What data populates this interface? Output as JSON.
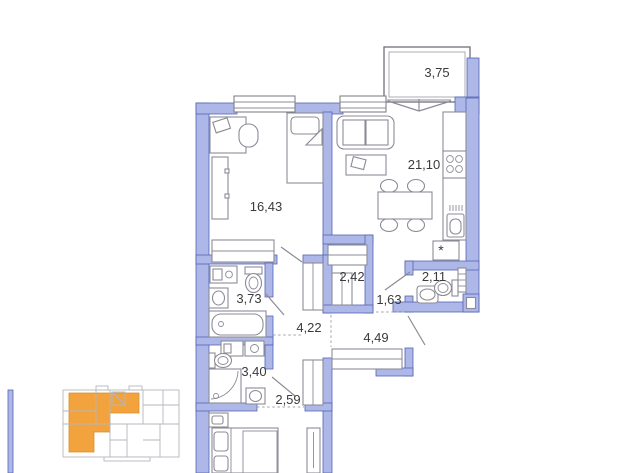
{
  "plan": {
    "rooms": [
      {
        "id": "balcony",
        "area": "3,75"
      },
      {
        "id": "bedroom",
        "area": "16,43"
      },
      {
        "id": "kitchen-living-room",
        "area": "21,10"
      },
      {
        "id": "wardrobe-closet",
        "area": "2,42"
      },
      {
        "id": "wc",
        "area": "2,11"
      },
      {
        "id": "corridor",
        "area": "1,63"
      },
      {
        "id": "bathroom",
        "area": "3,73"
      },
      {
        "id": "hallway",
        "area": "4,22"
      },
      {
        "id": "entry-hall",
        "area": "4,49"
      },
      {
        "id": "shower-room",
        "area": "3,40"
      },
      {
        "id": "passage",
        "area": "2,59"
      }
    ],
    "fridge_symbol": "*",
    "colors": {
      "wall_fill": "#aeb8e8",
      "wall_stroke": "#5364b4",
      "fixture_line": "#8b8b97",
      "label_text": "#3b3b3b",
      "minimap_highlight": "#f2a33e",
      "minimap_line": "#b4b7bd"
    }
  }
}
